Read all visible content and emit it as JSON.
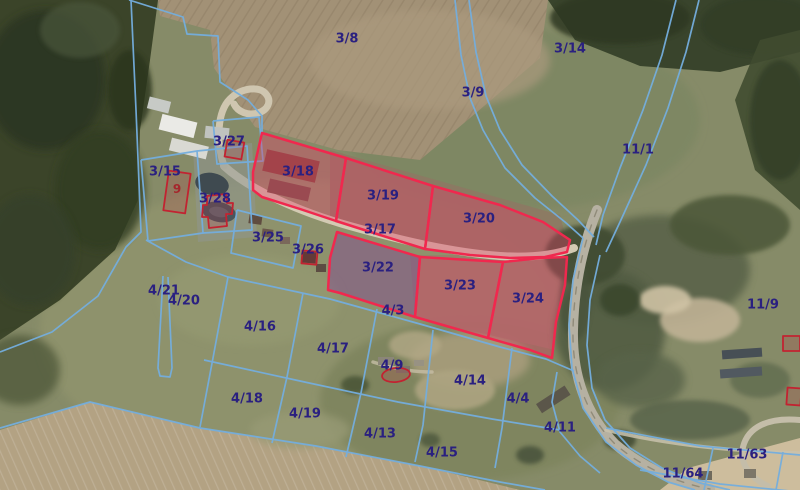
{
  "map": {
    "type": "cadastral-orthophoto",
    "colors": {
      "parcel_boundary_blue": "#74aede",
      "highlight_stroke_red": "#f0284e",
      "highlight_fill_pink": "rgba(226,62,104,0.38)",
      "highlight_fill_purple": "rgba(128,68,148,0.45)",
      "label_navy": "#2a2080",
      "building_outline_red": "#c22331",
      "building_label_red": "#a5262c"
    },
    "highlighted_parcels": [
      "3/18",
      "3/19",
      "3/20",
      "3/22",
      "3/23",
      "3/24"
    ],
    "parcel_labels": [
      {
        "text": "3/8",
        "x": 347,
        "y": 39,
        "color": "navy"
      },
      {
        "text": "3/14",
        "x": 570,
        "y": 49,
        "color": "navy"
      },
      {
        "text": "3/9",
        "x": 473,
        "y": 93,
        "color": "navy"
      },
      {
        "text": "11/1",
        "x": 638,
        "y": 150,
        "color": "navy"
      },
      {
        "text": "3/27",
        "x": 229,
        "y": 142,
        "color": "navy"
      },
      {
        "text": "3/15",
        "x": 165,
        "y": 172,
        "color": "navy"
      },
      {
        "text": "9",
        "x": 177,
        "y": 189,
        "color": "red"
      },
      {
        "text": "3/28",
        "x": 215,
        "y": 199,
        "color": "navy"
      },
      {
        "text": "3/18",
        "x": 298,
        "y": 172,
        "color": "navy"
      },
      {
        "text": "3/19",
        "x": 383,
        "y": 196,
        "color": "navy"
      },
      {
        "text": "3/20",
        "x": 479,
        "y": 219,
        "color": "navy"
      },
      {
        "text": "3/17",
        "x": 380,
        "y": 230,
        "color": "navy"
      },
      {
        "text": "3/25",
        "x": 268,
        "y": 238,
        "color": "navy"
      },
      {
        "text": "3/26",
        "x": 308,
        "y": 250,
        "color": "navy"
      },
      {
        "text": "3/22",
        "x": 378,
        "y": 268,
        "color": "navy"
      },
      {
        "text": "3/23",
        "x": 460,
        "y": 286,
        "color": "navy"
      },
      {
        "text": "3/24",
        "x": 528,
        "y": 299,
        "color": "navy"
      },
      {
        "text": "4/21",
        "x": 164,
        "y": 291,
        "color": "navy"
      },
      {
        "text": "4/20",
        "x": 184,
        "y": 301,
        "color": "navy"
      },
      {
        "text": "4/16",
        "x": 260,
        "y": 327,
        "color": "navy"
      },
      {
        "text": "4/17",
        "x": 333,
        "y": 349,
        "color": "navy"
      },
      {
        "text": "4/3",
        "x": 393,
        "y": 311,
        "color": "navy"
      },
      {
        "text": "4/9",
        "x": 392,
        "y": 366,
        "color": "navy"
      },
      {
        "text": "4/18",
        "x": 247,
        "y": 399,
        "color": "navy"
      },
      {
        "text": "4/19",
        "x": 305,
        "y": 414,
        "color": "navy"
      },
      {
        "text": "4/13",
        "x": 380,
        "y": 434,
        "color": "navy"
      },
      {
        "text": "4/14",
        "x": 470,
        "y": 381,
        "color": "navy"
      },
      {
        "text": "4/4",
        "x": 518,
        "y": 399,
        "color": "navy"
      },
      {
        "text": "4/11",
        "x": 560,
        "y": 428,
        "color": "navy"
      },
      {
        "text": "4/15",
        "x": 442,
        "y": 453,
        "color": "navy"
      },
      {
        "text": "11/9",
        "x": 763,
        "y": 305,
        "color": "navy"
      },
      {
        "text": "11/63",
        "x": 747,
        "y": 455,
        "color": "navy"
      },
      {
        "text": "11/64",
        "x": 683,
        "y": 474,
        "color": "navy"
      }
    ]
  }
}
